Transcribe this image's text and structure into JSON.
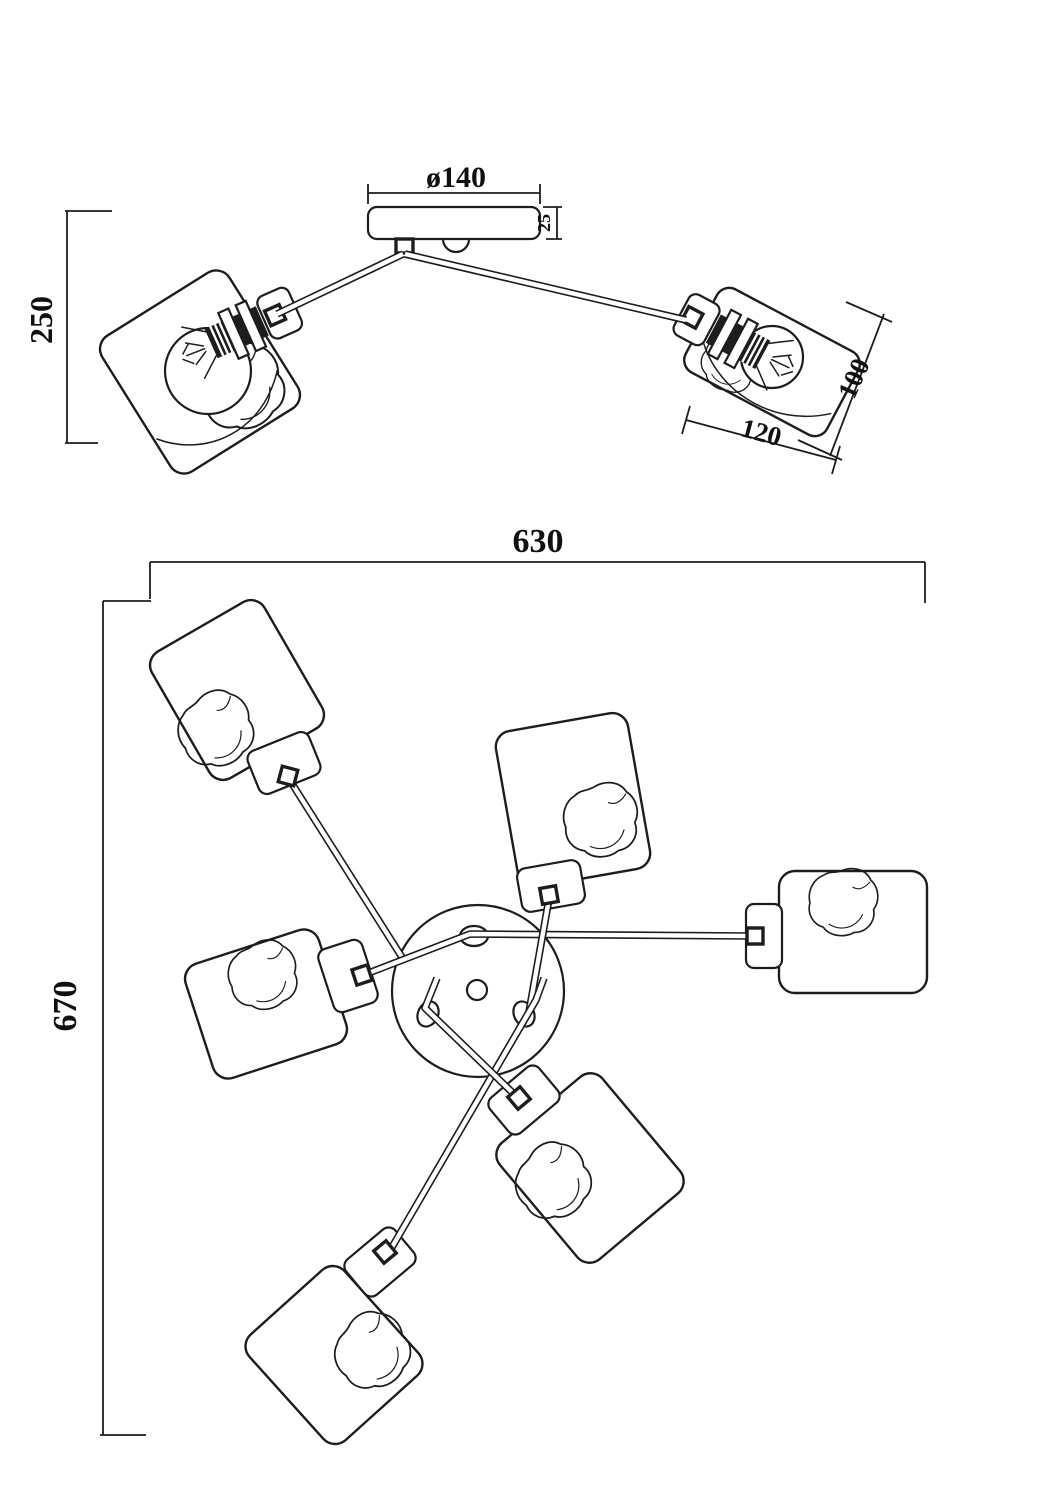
{
  "labels": {
    "canopy_diameter": "ø140",
    "canopy_height": "25",
    "fixture_height": "250",
    "shade_height": "100",
    "shade_width": "120",
    "plan_width": "630",
    "plan_height": "670"
  },
  "line_color": "#1d1d1d",
  "background_color": "#ffffff"
}
